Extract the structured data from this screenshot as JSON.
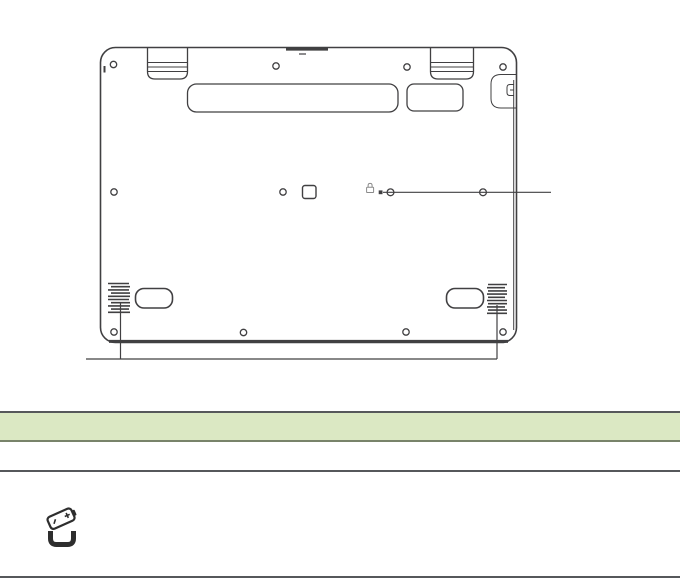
{
  "page": {
    "width": 680,
    "height": 581,
    "background": "#ffffff"
  },
  "figure": {
    "name": "laptop-bottom-view-diagram",
    "parts": [
      "hinge-left",
      "hinge-right",
      "vent-large",
      "vent-small",
      "screw-holes",
      "security-lock-slot",
      "card-slot-marker",
      "lock-glyph",
      "battery-reset-pinhole",
      "speaker-grille-left",
      "speaker-grille-right",
      "rubber-foot-left",
      "rubber-foot-right"
    ],
    "callouts": [
      {
        "name": "battery-reset-pinhole-callout",
        "side": "right"
      },
      {
        "name": "speakers-callout",
        "side": "bottom"
      }
    ]
  },
  "colors": {
    "background": "#ffffff",
    "line_art": "#414042",
    "table_header_fill": "#dbe8c3",
    "table_border": "#56585b",
    "table_header_border": "#78836a",
    "icon": "#2e2e2e",
    "lock_glyph": "#8a8a8a"
  },
  "table": {
    "header": {
      "label": ""
    },
    "rows": [
      {
        "label": ""
      },
      {
        "icon": "battery-icon",
        "label": ""
      }
    ]
  },
  "icons": {
    "battery": "battery-icon",
    "lock": "lock-icon",
    "pinhole": "battery-reset-pinhole"
  }
}
